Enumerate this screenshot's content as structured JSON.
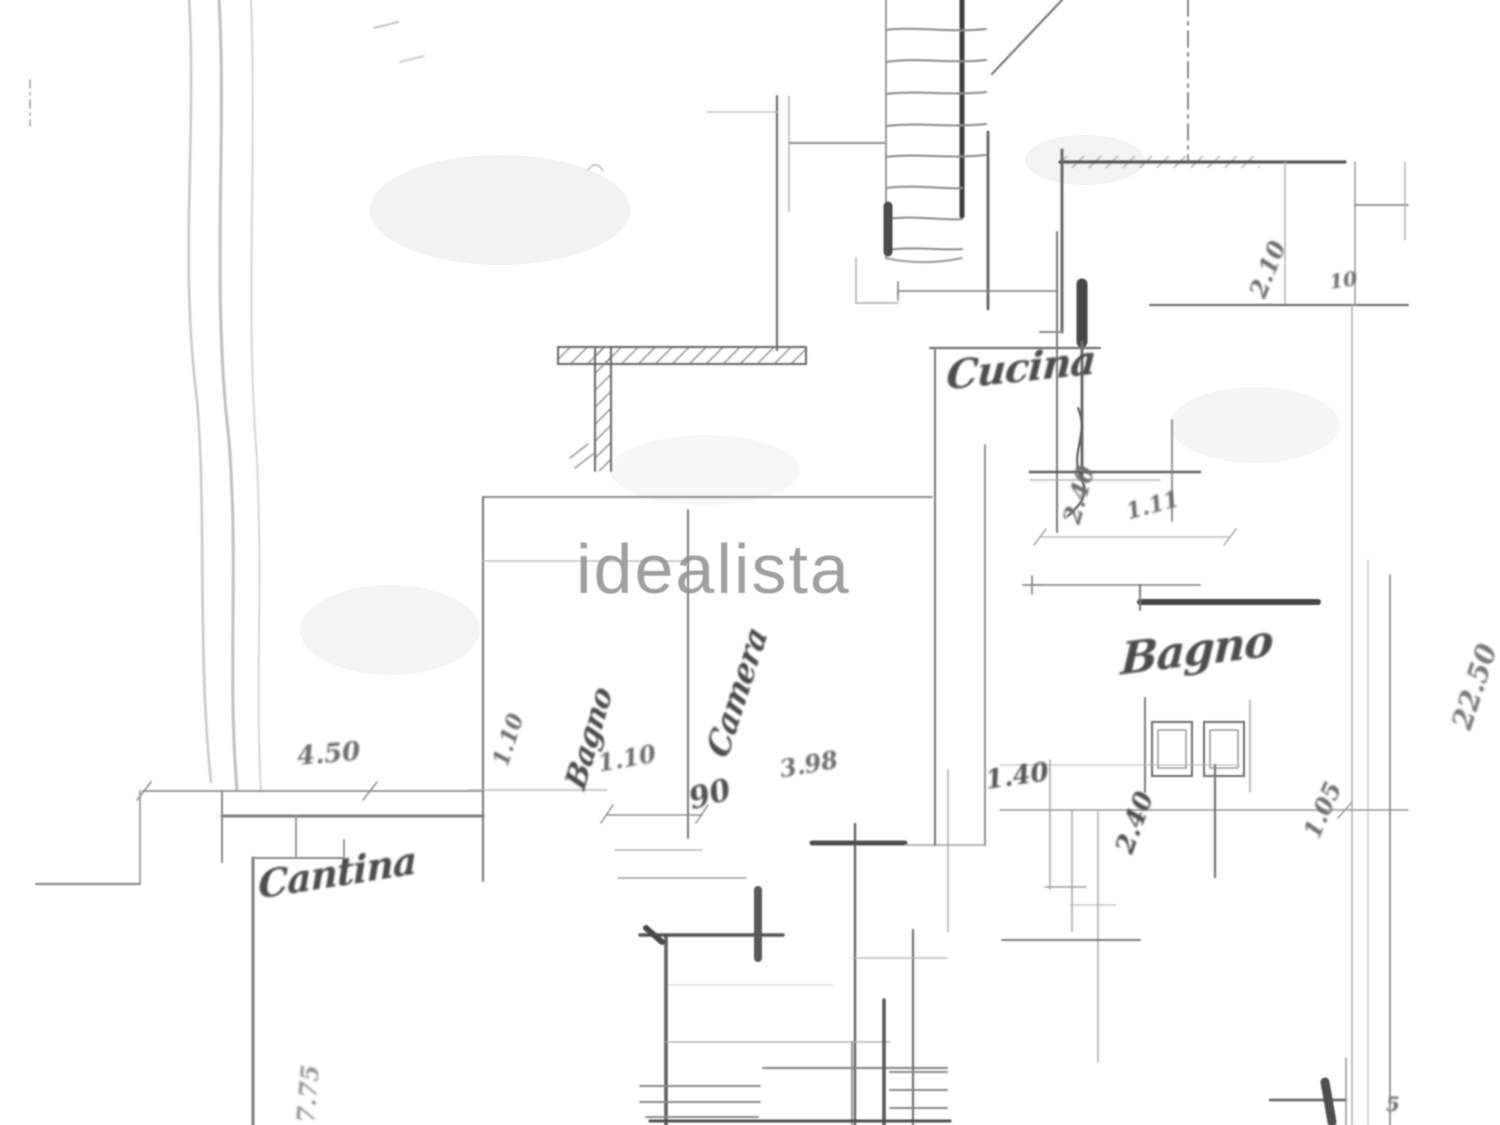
{
  "watermark": "idealista",
  "room_labels": {
    "kitchen": "Cucina",
    "bathroom": "Bagno",
    "bathroom_inner": "Bagno",
    "bedroom": "Camera",
    "cellar": "Cantina"
  },
  "dimensions": {
    "site_width": "4.50",
    "hall_width": "1.10",
    "door_width": "90",
    "room_width": "3.98",
    "passage_width": "1.40",
    "bath_width": "2.40",
    "dim_105": "1.05",
    "upper_room": "2.10",
    "wall_thickness": "10",
    "kitchen_depth": "2.40",
    "dim_111": "1.11",
    "site_length": "22.50",
    "cellar_depth": "7.75",
    "corner_mark": "5",
    "stair_width": "1.10"
  },
  "colors": {
    "ink": "#4a4a4a",
    "faint": "#9b9b9b",
    "watermark": "#909090",
    "paper": "#ffffff"
  }
}
